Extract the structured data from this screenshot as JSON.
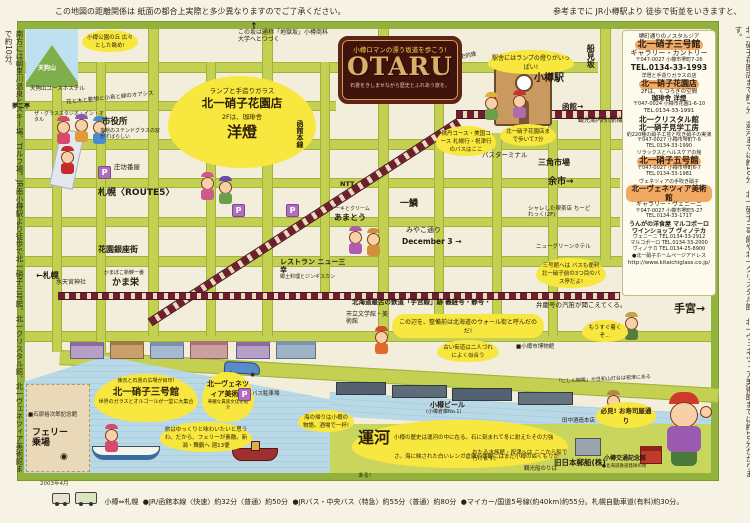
{
  "margins": {
    "top_left": "この地図の距離関係は 紙面の都合上実際と多少異なりますのでご了承ください。",
    "top_right": "参考までに JR小樽駅より 徒歩で街並をいきますと、",
    "left_vertical": "南方には朝里川温泉とスキー場、ゴルフ場。JR南小樽駅より徒歩で北一硝子三号館、北一クリスタル館、北一ヴェネツィア美術館まで約10分。",
    "right_vertical": "北一硝子花園店まで約7分。運河までは約10分。北一硝子三号館や北一クリスタル館、北一ヴェネツィア美術館までは約10分かかります。",
    "stamp": "2003年4月"
  },
  "legend": {
    "route": "小樽⇔札幌",
    "jr": "●JR/函館本線〈快速〉約32分〈普通〉約50分",
    "bus": "●JRバス・中央バス〈特急〉約55分〈普通〉約80分",
    "car": "●マイカー/国道5号線(約40km)約55分。札幌自動車道(有料)約30分。"
  },
  "sign": {
    "tagline": "小樽ロマンの漂う坂道を歩こう!",
    "title": "OTARU",
    "subtitle": "石畳をきしませながら歴史とふれあう旅を。"
  },
  "station": {
    "name": "小樽駅",
    "heritage": "昭和9年の歴史的建造物",
    "lamp_bubble": "駅舎にはランプの燈りがいっぱい!",
    "info": "観光案内所(駅構内)",
    "hakodate_arrow": "函館→",
    "funamizaka": "船見坂",
    "bus_terminal": "バスターミナル",
    "shakotan": "積丹コース・美国コース 札幌行・祝津行のバスはここ",
    "walk7": "北一硝子花園店まで歩いて7分",
    "sankaku": "三角市場",
    "yoichi": "余市→"
  },
  "sidebar": {
    "header": "堺町通りのノスタルジア",
    "s1": {
      "name": "北一硝子三号館",
      "sub": "ギャラリー・カントリー",
      "addr": "〒047-0027 小樽市堺町7-26",
      "tel": "TEL.0134-33-1993"
    },
    "s2": {
      "cap": "洋燈と手造りガラスの店",
      "name": "北一硝子花園店",
      "sub": "2Fは、くつろぎの空間",
      "sub2": "珈琲舎 洋燈",
      "addr": "〒047-0024 小樽市花園1-6-10",
      "tel": "TEL.0134-33-1991"
    },
    "s3": {
      "name": "北一クリスタル館",
      "name2": "北一硝子見学工房",
      "sub": "約220種の硝子工芸と吹き硝子の実演",
      "addr": "〒047-0027 小樽市堺町7-6",
      "tel": "TEL.0134-33-1990"
    },
    "s4": {
      "cap": "リラックスとヘルスケアの館",
      "name": "北一硝子五号館",
      "addr": "〒047-0027 小樽市堺町6-7",
      "tel": "TEL.0134-33-1981"
    },
    "s5": {
      "cap": "ヴェネツィアの手吹き硝子",
      "name": "北一ヴェネツィア美術館",
      "sub": "ギャラリー・ヴェニーニ",
      "addr": "〒047-0027 小樽市堺町5-27",
      "tel": "TEL.0134-33-1717"
    },
    "s6": {
      "name": "うんがの洋食屋 マルコポーロ",
      "name2": "ワインショップ ヴィノテカ",
      "tel1": "ヴェニーニ TEL.0134-33-2912",
      "tel2": "マルコポーロ TEL.0134-33-2000",
      "tel3": "ヴィノテカ TEL.0134-25-8900"
    },
    "hp_label": "●北一硝子ホームページアドレス",
    "hp": "http://www.kitaichiglass.co.jp/"
  },
  "bubbles": {
    "park": "小樽公園の丘 広々とした眺め!",
    "jigoku": "この坂は通称「地獄坂」小樽商科大学へとつづく",
    "lamp": {
      "cap": "ランプと手造りガラス",
      "name": "北一硝子花園店",
      "line": "2Fは、珈琲舎",
      "big": "洋燈"
    },
    "sangokan": {
      "cap": "煉瓦と石畳の広場が目印!",
      "name": "北一硝子三号館",
      "sub": "世界のガラスとオルゴールが一堂に大集合"
    },
    "venezia": {
      "name": "北一ヴェネツィア美術館",
      "sub": "華麗な貴族文化を紹介"
    },
    "wall": "この辺を、整備前は北海道のウォール街と呼んだのだ!",
    "kaido": "古い街道は二人づれによく似合う",
    "bus3": "三号館へは バスも便利 北一硝子前の3つ目のバス停だよ!",
    "soon": "もうすぐ着くぞ…",
    "canal": {
      "name": "運河",
      "text": "小樽の歴史は運河の中に在る。石に刻まれて冬に耐えたその力強さ。海に映された白いレンガ倉庫の景観にはまだ小樽のぬくもりがある!"
    },
    "umi": "海の帰りは小樽の物語。酒場で一杯!",
    "ferry": "旅はゆっくりと味わいたいと思うわ。だから、フェリーが素敵。新潟・舞鶴へ 週13便",
    "hikken": "必見! お寿司屋通り",
    "aquarium": "おたる水族館・祝津へは ここから船で行けます。"
  },
  "labels": {
    "tengu": "天狗山ユースホステル",
    "glass_studio": "ザ・グラススタジオ・イン・オタル",
    "yumeji": "夢二亭",
    "oasis": "花と木と動物と小鳥と緑のオアシス",
    "cityhall": "市役所",
    "cityhall_note": "本館のステンドグラスの窓がすばらしい",
    "shobo": "庄坊番屋",
    "route5": "札幌〈ROUTE5〉",
    "sapporo_arrow": "←札幌",
    "hanazono": "花園銀座街",
    "suitengu": "水天宮神社",
    "kamaei": "かま栄",
    "kamaei_note": "かまぼこ新鮮一番",
    "hakodate_line": "函館本線",
    "ntt": "NTT",
    "amato": "あまとう",
    "amato_note": "ケーキとクリーム",
    "ichirin": "一鱗",
    "miyako": "みやこ通り",
    "december": "December 3 →",
    "sanko": "レストラン ニュー三幸",
    "sanko_note": "郷土料理とジンギスカン",
    "temiya_line1": "北海道最古の鉄道「手宮線」跡 義経号・静号・",
    "temiya_line2": "弁慶号の汽笛が聞こえてくる。",
    "bungakukan": "市立文学館・美術館",
    "chidoreku": "シャレした喫茶店 ちーどれっく(2F)",
    "green_hotel": "ニューグリーンホテル",
    "beer": "小樽ビール",
    "beer_note": "(小樽倉庫No.1)",
    "yusen": "旧日本郵船(株)",
    "tanaka": "田中酒造本店",
    "kotsu": "小樽交通記念館",
    "kotsu_note": "●北海道鉄道発祥の地",
    "kankosen": "観光船のりば",
    "ishihara": "■石原裕次郎記念館",
    "ferry_t": "フェリー乗場",
    "bus_parking": "バス駐車場",
    "museum": "■小樽市博物館",
    "nishin": "「にしん御殿」や日和山灯台は祝津にある",
    "temiya_big": "手宮→",
    "tenguyama": "天狗山"
  }
}
